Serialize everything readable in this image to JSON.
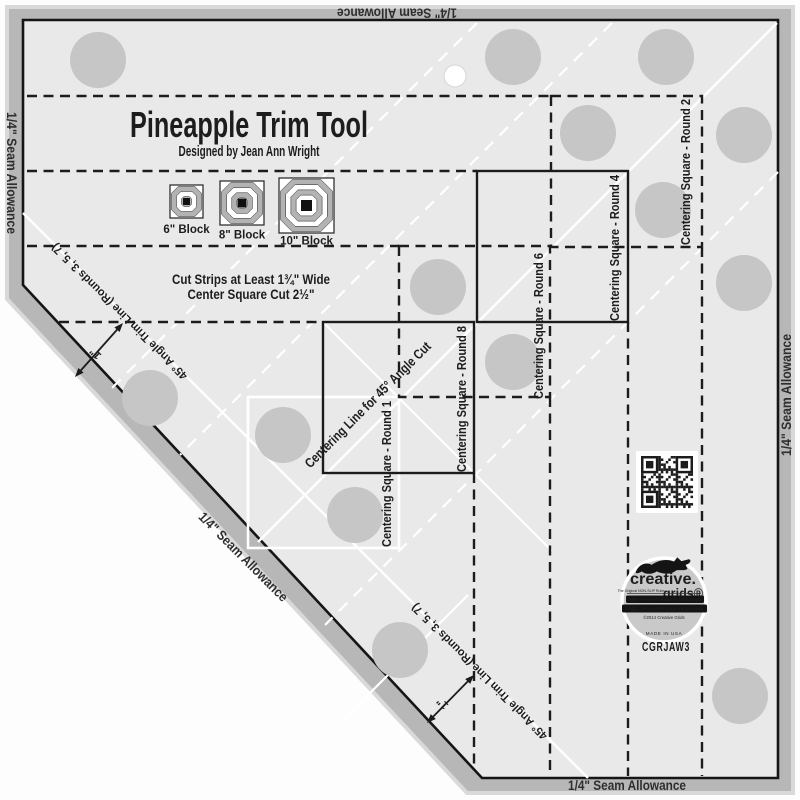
{
  "header": {
    "title": "Pineapple Trim Tool",
    "subtitle": "Designed by Jean Ann Wright"
  },
  "block_diagrams": [
    {
      "label": "6\" Block"
    },
    {
      "label": "8\" Block"
    },
    {
      "label": "10\" Block"
    }
  ],
  "instructions": {
    "line1": "Cut Strips at Least 1¾\" Wide",
    "line2": "Center Square Cut 2½\""
  },
  "seam_labels": {
    "top": "1/4\" Seam Allowance",
    "left": "1/4\" Seam Allowance",
    "right": "1/4\" Seam Allowance",
    "bottom": "1/4\" Seam Allowance",
    "diagonal": "1/4\" Seam Allowance"
  },
  "guides": {
    "round1": "Centering Square - Round 1",
    "round2": "Centering Square - Round 2",
    "round4": "Centering Square - Round 4",
    "round6": "Centering Square - Round 6",
    "round8": "Centering Square - Round 8",
    "centering_line": "Centering Line for 45° Angle Cut",
    "trim_line": "45° Angle Trim Line (Rounds 3, 5, 7)",
    "inch_marker": "1\""
  },
  "branding": {
    "brand_primary": "creative.",
    "brand_secondary": "grids®",
    "tagline": "The Original NON-SLIP Ruler",
    "url_uk": "UK - www.creativegrids.com",
    "url_usa": "USA - www.creativegridsusa.com",
    "copyright": "©2014 Creative Grids",
    "made_in": "MADE IN USA",
    "product_code": "CGRJAW3"
  },
  "colors": {
    "band": "#b7b7b7",
    "surface": "#e9e9e9",
    "ink": "#1c1c1c",
    "grip_dot": "#c6c6c6",
    "white": "#ffffff",
    "logo_circle": "#c9c9c9"
  }
}
